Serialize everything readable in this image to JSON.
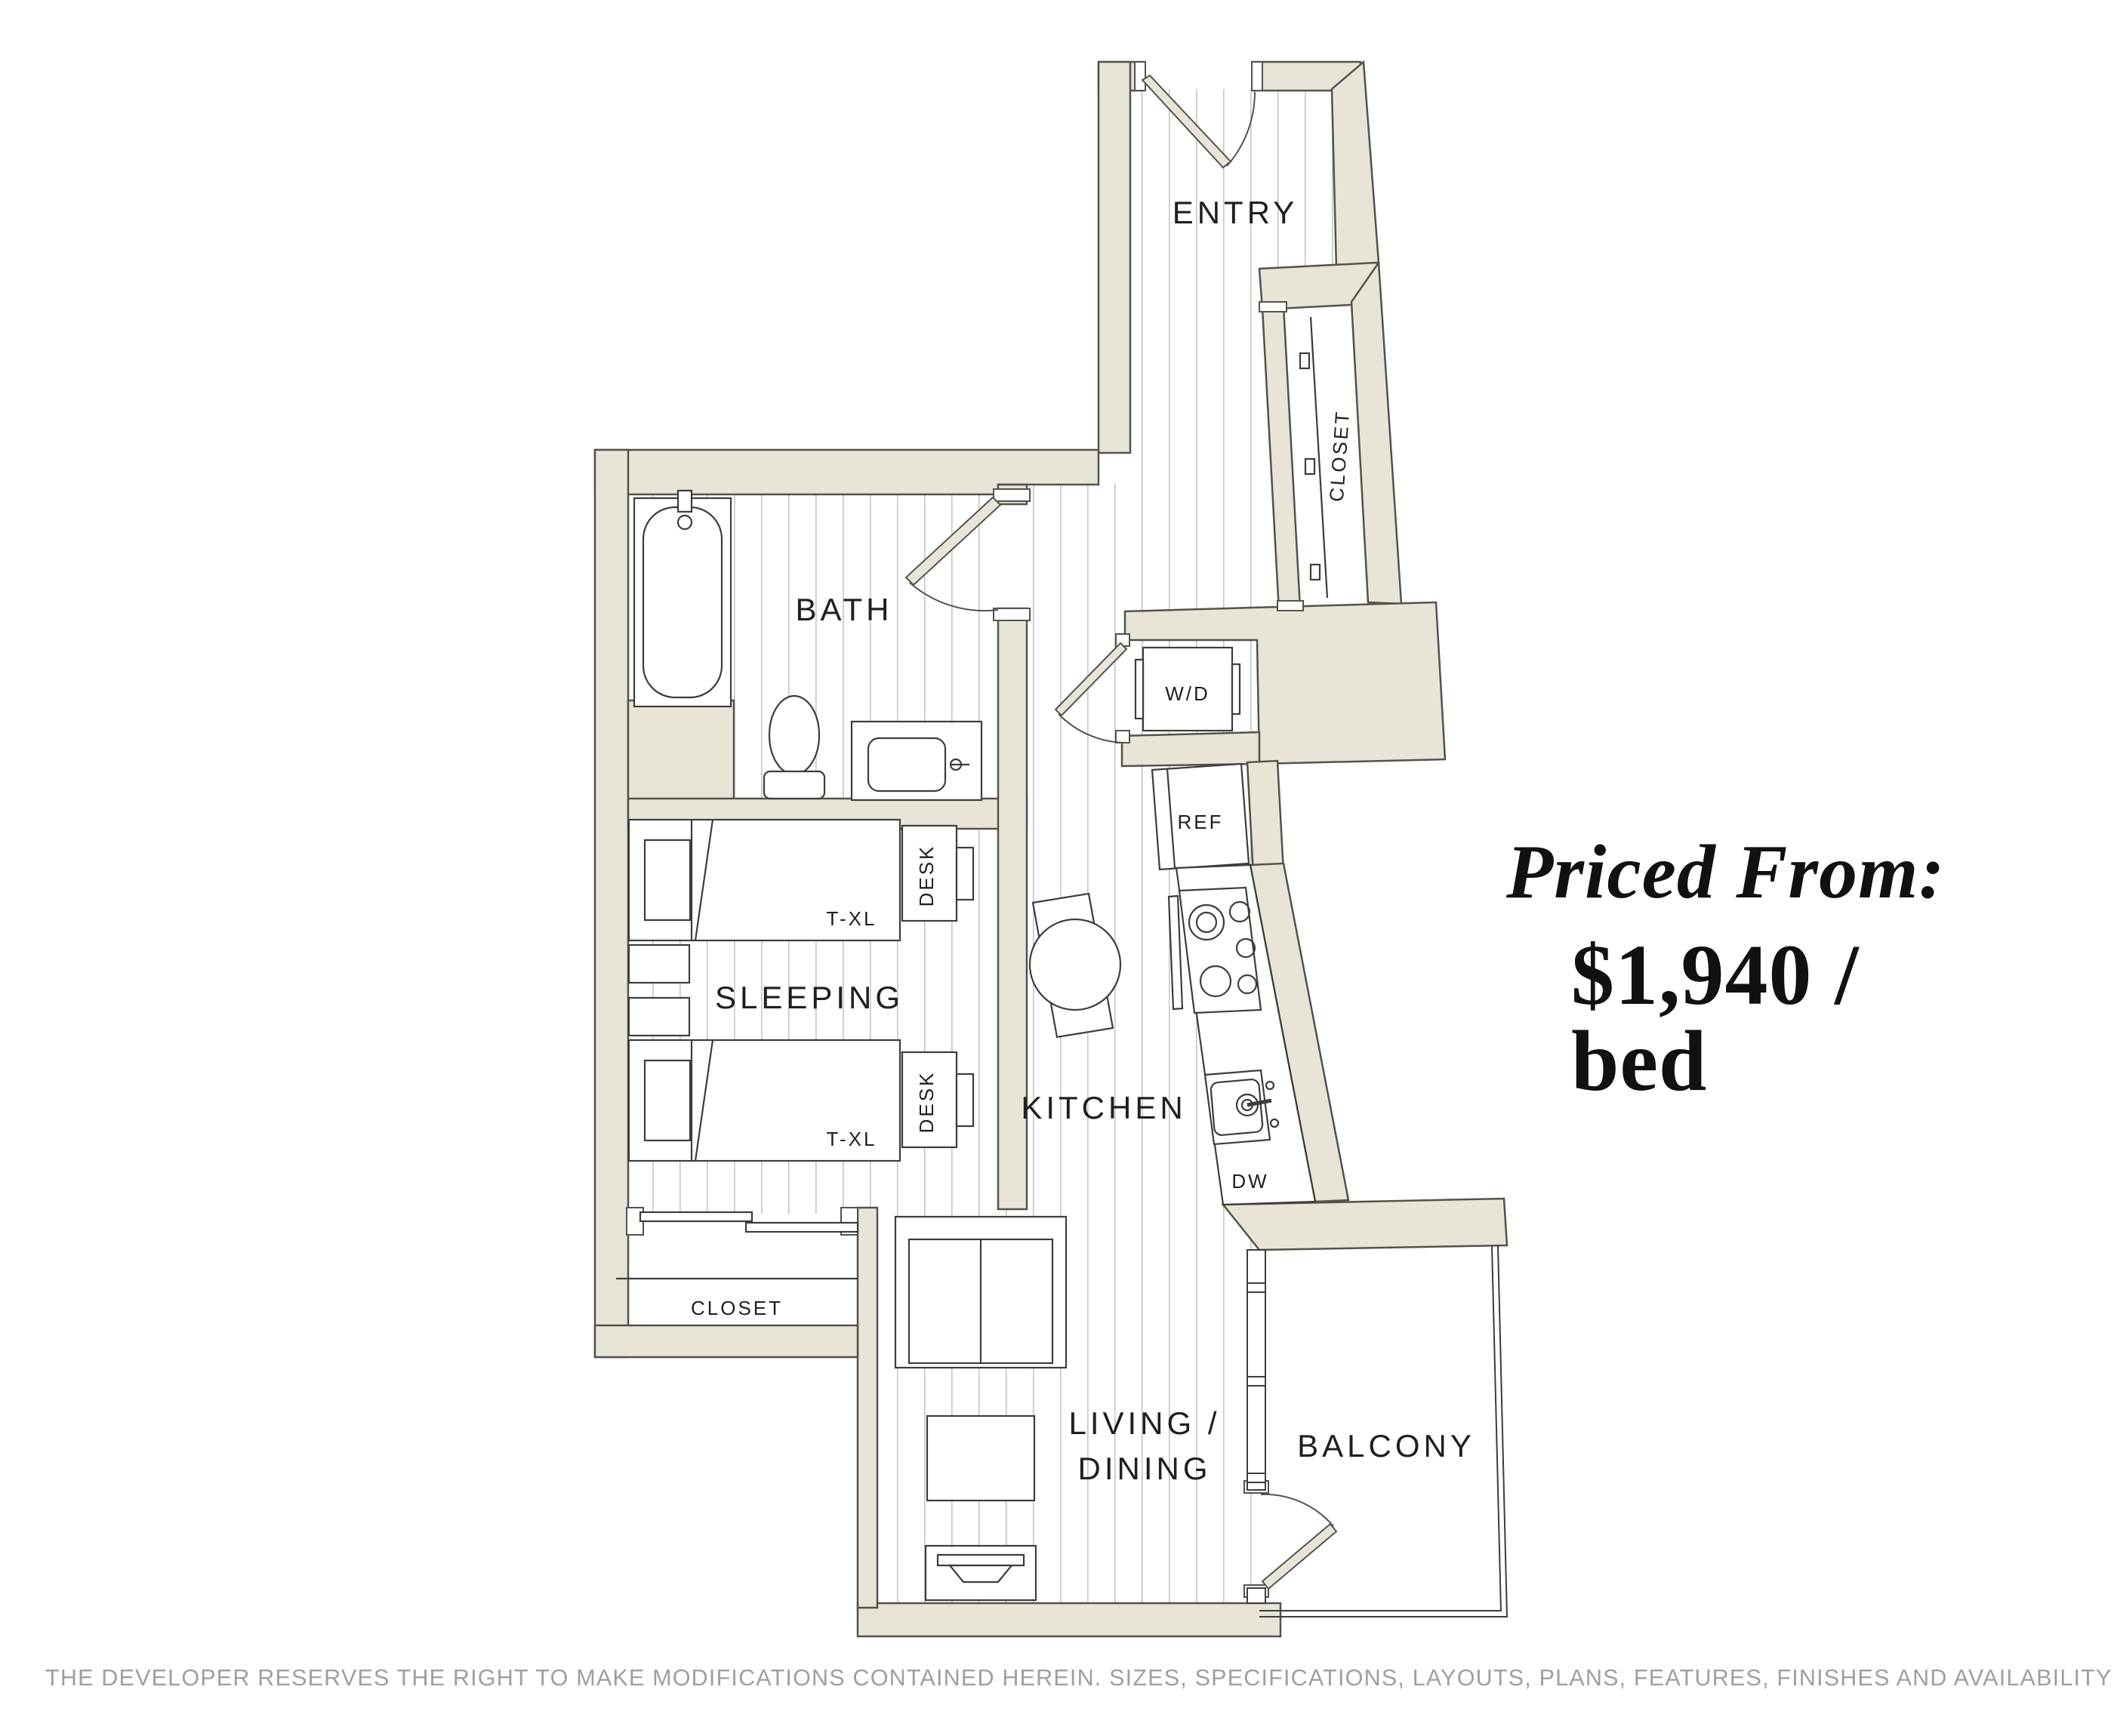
{
  "floorplan": {
    "rooms": {
      "entry": "ENTRY",
      "bath": "BATH",
      "sleeping": "SLEEPING",
      "kitchen": "KITCHEN",
      "living_line1": "LIVING /",
      "living_line2": "DINING",
      "balcony": "BALCONY"
    },
    "fixtures": {
      "entry_closet": "CLOSET",
      "sleeping_closet": "CLOSET",
      "washer_dryer": "W/D",
      "refrigerator": "REF",
      "dishwasher": "DW",
      "bed1_size": "T-XL",
      "bed2_size": "T-XL",
      "desk1": "DESK",
      "desk2": "DESK"
    },
    "colors": {
      "wall_fill": "#e8e5d8",
      "wall_outline": "#54524b",
      "floor_line": "#c6c6c4",
      "fixture_line": "#3d3d3a",
      "label_ink": "#1f1f1f"
    }
  },
  "pricing": {
    "heading": "Priced From:",
    "price": "$1,940 / bed"
  },
  "footer": {
    "disclaimer": "THE DEVELOPER RESERVES THE RIGHT TO MAKE MODIFICATIONS CONTAINED HEREIN. SIZES, SPECIFICATIONS, LAYOUTS, PLANS, FEATURES, FINISHES AND AVAILABILITY MAY CHANGE WITHOUT NOTICE. E.&O.E."
  }
}
